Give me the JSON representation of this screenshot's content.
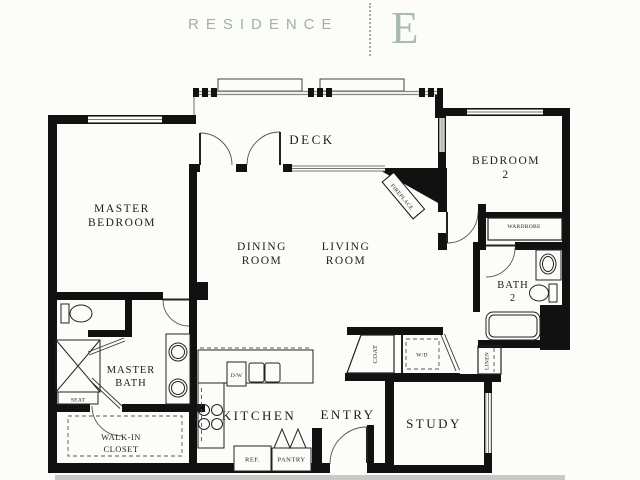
{
  "header": {
    "title": "RESIDENCE",
    "unit_letter": "E",
    "title_color": "#9fb3a4",
    "letter_color": "#a9bcac"
  },
  "rooms": {
    "master_bedroom": {
      "line1": "MASTER",
      "line2": "BEDROOM"
    },
    "deck": {
      "label": "DECK"
    },
    "dining_room": {
      "line1": "DINING",
      "line2": "ROOM"
    },
    "living_room": {
      "line1": "LIVING",
      "line2": "ROOM"
    },
    "bedroom2": {
      "line1": "BEDROOM",
      "line2": "2"
    },
    "bath2": {
      "line1": "BATH",
      "line2": "2"
    },
    "master_bath": {
      "line1": "MASTER",
      "line2": "BATH"
    },
    "walk_in_closet": {
      "line1": "WALK-IN",
      "line2": "CLOSET"
    },
    "kitchen": {
      "label": "KITCHEN"
    },
    "entry": {
      "label": "ENTRY"
    },
    "study": {
      "label": "STUDY"
    }
  },
  "fixtures": {
    "fireplace": "FIREPLACE",
    "wardrobe": "WARDROBE",
    "seat": "SEAT",
    "dishwasher": "D/W",
    "refrigerator": "REF.",
    "pantry": "PANTRY",
    "coat": "COAT",
    "washer_dryer": "W/D",
    "linen": "LINEN"
  },
  "colors": {
    "walls": "#111111",
    "background": "#fcfcf8",
    "shadow_bar": "#c9c9c9"
  }
}
